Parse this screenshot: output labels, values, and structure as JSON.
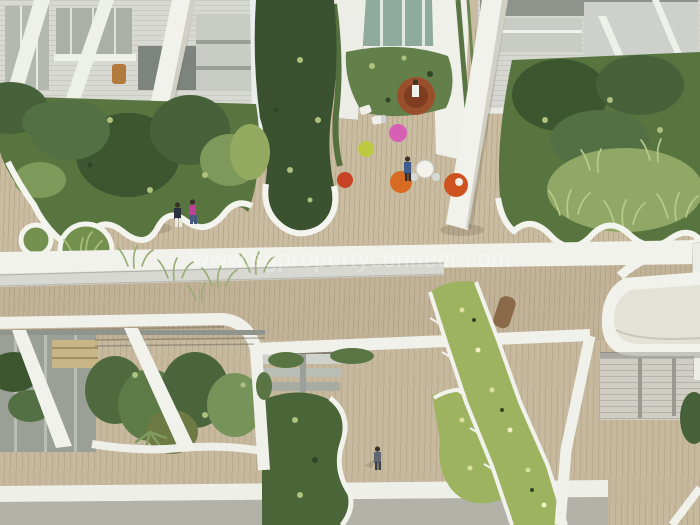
{
  "meta": {
    "description": "Aerial architectural rendering of a lush multi-level sky-terrace courtyard: white leaning columns, timber plank decks, organic white-rimmed planter islands, hanging vine curtains, colourful round poufs and residents walking between garden beds."
  },
  "watermark": {
    "text": "www.sgpropertyconnect.com",
    "color": "rgba(255,255,255,0.55)"
  },
  "palette": {
    "deck": "#cabca1",
    "deck_mid": "#c2b398",
    "white": "#f2f2ec",
    "white_soft": "#e4e1d7",
    "mesh": "#d8d8d2",
    "bottom_white": "#efefe9",
    "bottom_grey": "#b3b2a9",
    "glass": "#8fab9d",
    "green_dark": "#3a5230",
    "green_mid": "#587540",
    "green_shrub": "#64804a",
    "green_vine": "#4a6538",
    "green_flower": "#9db35f",
    "rust_seat": "#9a4f2c",
    "pouf_pink": "#d760b5",
    "pouf_lime": "#bdc93f",
    "pouf_orange": "#d76b22",
    "pouf_red": "#c64326",
    "chair_orange": "#cf5320",
    "lounger_brown": "#8a6a48",
    "person_jacket": "#2c3140",
    "person_pink_top": "#bd3f98",
    "person_jeans": "#44597c",
    "person_white_shirt": "#efefeb",
    "person_blue": "#3f5c8e",
    "person_walker": "#5d6672"
  }
}
